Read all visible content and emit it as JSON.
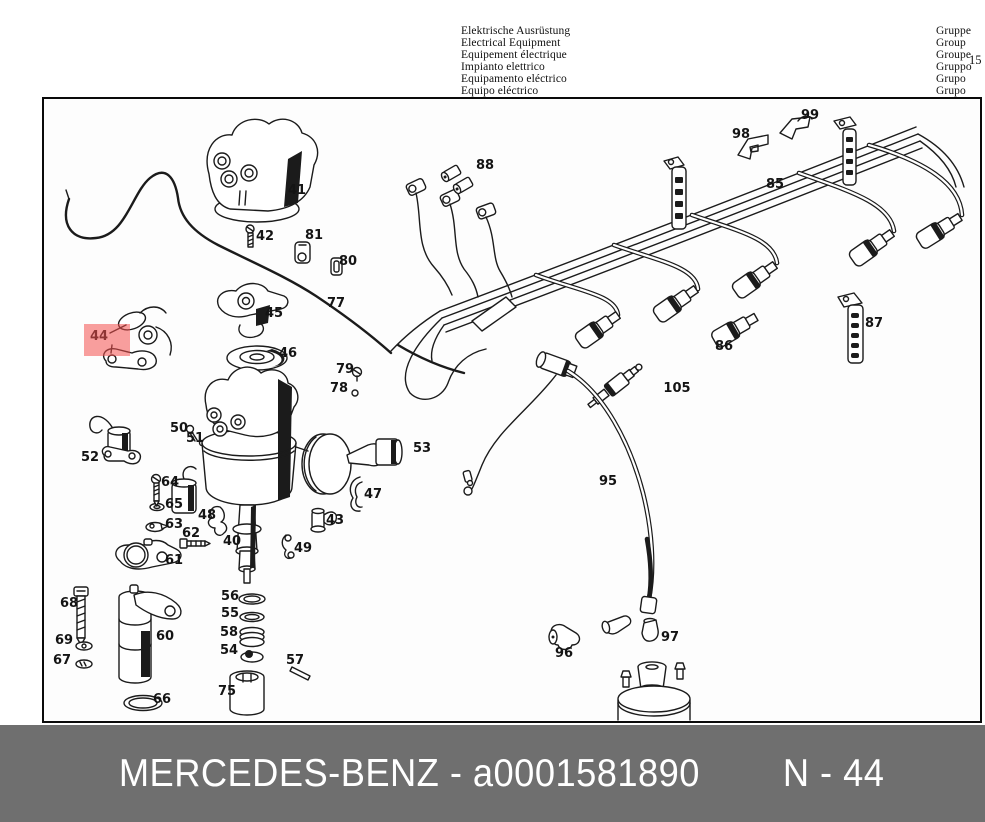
{
  "header": {
    "languages": [
      "Elektrische Ausrüstung",
      "Electrical Equipment",
      "Equipement électrique",
      "Impianto elettrico",
      "Equipamento eléctrico",
      "Equipo eléctrico"
    ],
    "group_labels": [
      "Gruppe",
      "Group",
      "Groupe",
      "Gruppo",
      "Grupo",
      "Grupo"
    ],
    "group_number": "15"
  },
  "diagram": {
    "title_hint": "ignition distributor and cable harness exploded view",
    "highlight": {
      "label": "44",
      "x": 40,
      "y": 225,
      "w": 46,
      "h": 32,
      "color": "#f4504e",
      "opacity": 0.55
    },
    "labels": [
      {
        "t": "41",
        "x": 253,
        "y": 95
      },
      {
        "t": "42",
        "x": 221,
        "y": 141
      },
      {
        "t": "81",
        "x": 270,
        "y": 140
      },
      {
        "t": "80",
        "x": 304,
        "y": 166
      },
      {
        "t": "77",
        "x": 292,
        "y": 208
      },
      {
        "t": "45",
        "x": 230,
        "y": 218
      },
      {
        "t": "46",
        "x": 244,
        "y": 258
      },
      {
        "t": "44",
        "x": 55,
        "y": 241
      },
      {
        "t": "79",
        "x": 301,
        "y": 274
      },
      {
        "t": "78",
        "x": 295,
        "y": 293
      },
      {
        "t": "88",
        "x": 441,
        "y": 70
      },
      {
        "t": "98",
        "x": 697,
        "y": 39
      },
      {
        "t": "99",
        "x": 766,
        "y": 20
      },
      {
        "t": "85",
        "x": 731,
        "y": 89
      },
      {
        "t": "87",
        "x": 830,
        "y": 228
      },
      {
        "t": "86",
        "x": 680,
        "y": 251
      },
      {
        "t": "105",
        "x": 633,
        "y": 293
      },
      {
        "t": "52",
        "x": 46,
        "y": 362
      },
      {
        "t": "50",
        "x": 135,
        "y": 333
      },
      {
        "t": "51",
        "x": 151,
        "y": 343
      },
      {
        "t": "53",
        "x": 378,
        "y": 353
      },
      {
        "t": "64",
        "x": 126,
        "y": 387
      },
      {
        "t": "65",
        "x": 130,
        "y": 409
      },
      {
        "t": "63",
        "x": 130,
        "y": 429
      },
      {
        "t": "62",
        "x": 147,
        "y": 438
      },
      {
        "t": "61",
        "x": 130,
        "y": 465
      },
      {
        "t": "48",
        "x": 163,
        "y": 420
      },
      {
        "t": "40",
        "x": 188,
        "y": 446
      },
      {
        "t": "43",
        "x": 291,
        "y": 425
      },
      {
        "t": "47",
        "x": 329,
        "y": 399
      },
      {
        "t": "49",
        "x": 259,
        "y": 453
      },
      {
        "t": "95",
        "x": 564,
        "y": 386
      },
      {
        "t": "68",
        "x": 25,
        "y": 508
      },
      {
        "t": "69",
        "x": 20,
        "y": 545
      },
      {
        "t": "67",
        "x": 18,
        "y": 565
      },
      {
        "t": "60",
        "x": 121,
        "y": 541
      },
      {
        "t": "66",
        "x": 118,
        "y": 604
      },
      {
        "t": "56",
        "x": 186,
        "y": 501
      },
      {
        "t": "55",
        "x": 186,
        "y": 518
      },
      {
        "t": "58",
        "x": 185,
        "y": 537
      },
      {
        "t": "54",
        "x": 185,
        "y": 555
      },
      {
        "t": "57",
        "x": 251,
        "y": 565
      },
      {
        "t": "75",
        "x": 183,
        "y": 596
      },
      {
        "t": "96",
        "x": 520,
        "y": 558
      },
      {
        "t": "97",
        "x": 626,
        "y": 542
      }
    ]
  },
  "footer": {
    "left_text": "MERCEDES-BENZ - a0001581890",
    "right_text": "N - 44",
    "bar_color": "#6f6f6f"
  }
}
